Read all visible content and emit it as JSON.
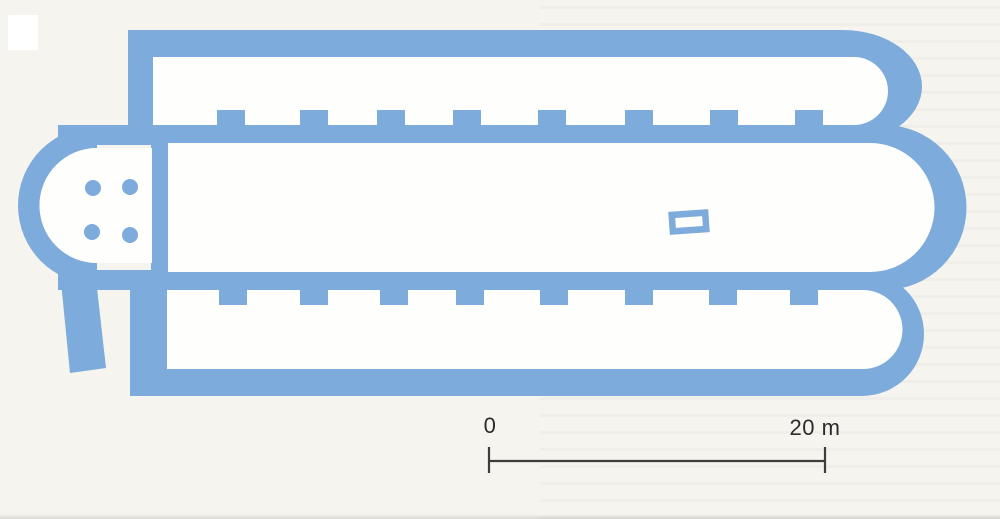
{
  "figure": {
    "subject": "basilica-floor-plan",
    "ink_color": "#7DABDC",
    "paper_color": "#F5F4EF",
    "interior_color": "#FEFEFC",
    "artifact_color": "#FFFFFF"
  },
  "scale_bar": {
    "start_label": "0",
    "end_label": "20 m",
    "line_color": "#3C3C3C",
    "text_color": "#2B2B2B"
  },
  "plan": {
    "pilasters": {
      "top_x": [
        217,
        300,
        377,
        453,
        538,
        625,
        710,
        795
      ],
      "bottom_x": [
        219,
        300,
        380,
        456,
        540,
        625,
        709,
        790
      ],
      "width": 28,
      "height": 16,
      "top_y": 110,
      "bottom_y": 289
    },
    "columns": {
      "radius": 8,
      "centers": [
        [
          93,
          188
        ],
        [
          130,
          187
        ],
        [
          92,
          232
        ],
        [
          130,
          235
        ]
      ]
    },
    "altar": {
      "cx": 689,
      "cy": 222,
      "outer_w": 40,
      "outer_h": 23,
      "inner_w": 27,
      "inner_h": 10,
      "angle_deg": -4
    }
  }
}
